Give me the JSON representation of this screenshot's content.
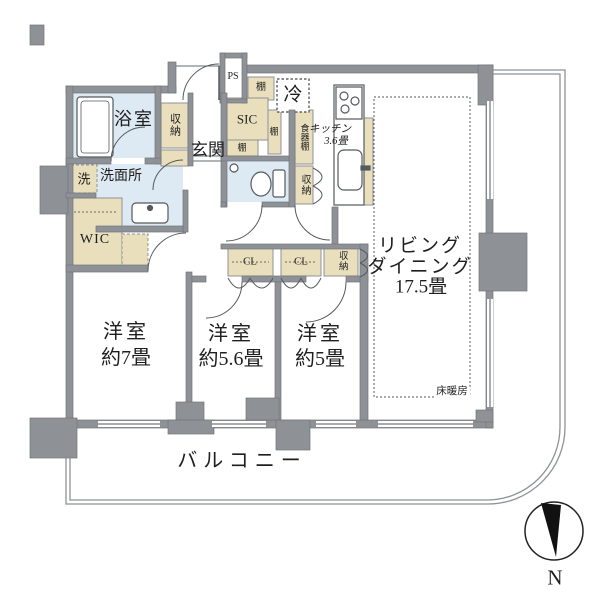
{
  "floor_plan": {
    "rooms": {
      "bathroom": "浴室",
      "washroom": "洗面所",
      "washing_machine": "洗",
      "wic": "WIC",
      "entrance": "玄関",
      "pipe_space": "PS",
      "shoe_closet": "SIC",
      "refrigerator": "冷",
      "kitchen_name": "キッチン",
      "kitchen_size": "3.6畳",
      "living_line1": "リビング",
      "living_line2": "ダイニング",
      "living_size": "17.5畳",
      "floor_heating": "床暖房",
      "bedroom1_name": "洋室",
      "bedroom1_size": "約7畳",
      "bedroom2_name": "洋室",
      "bedroom2_size": "約5.6畳",
      "bedroom3_name": "洋室",
      "bedroom3_size": "約5畳",
      "balcony": "バルコニー"
    },
    "storage": {
      "entrance_storage": "収納",
      "hall_storage": "収納",
      "living_storage": "収納",
      "closet1": "CL",
      "closet2": "CL",
      "shelf_top": "棚",
      "shelf_side": "棚",
      "shelf_bottom": "棚",
      "cupboard": "食器棚"
    },
    "compass_north": "N",
    "colors": {
      "wall": "#8e9296",
      "wet_area": "#dde9f3",
      "storage": "#e9dfbd",
      "counter": "#efe6cb",
      "line": "#555a5e",
      "text": "#1a1a1a"
    }
  }
}
